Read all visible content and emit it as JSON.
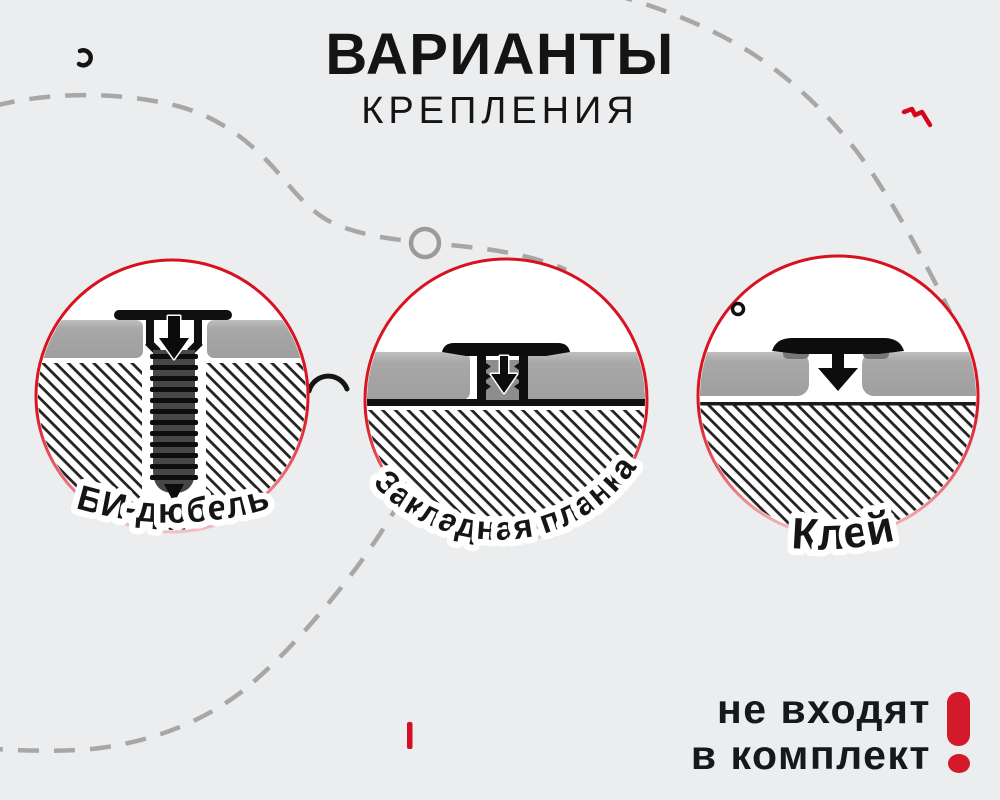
{
  "title": {
    "line1": "ВАРИАНТЫ",
    "line2": "КРЕПЛЕНИЯ"
  },
  "options": [
    {
      "id": "bi-dowel",
      "label": "БИ-дюбель"
    },
    {
      "id": "mounting-plate",
      "label": "Закладная планка"
    },
    {
      "id": "glue",
      "label": "Клей"
    }
  ],
  "note": {
    "line1": "не входят",
    "line2": "в комплект"
  },
  "colors": {
    "background": "#ecedee",
    "red_accent": "#d8121f",
    "exclamation_red": "#d31a2b",
    "ink": "#161616",
    "panel_gray": "#a8a8a8",
    "glue_pad_gray": "#767676",
    "dash_gray": "#a7a7a7",
    "hatch_black": "#232323"
  }
}
